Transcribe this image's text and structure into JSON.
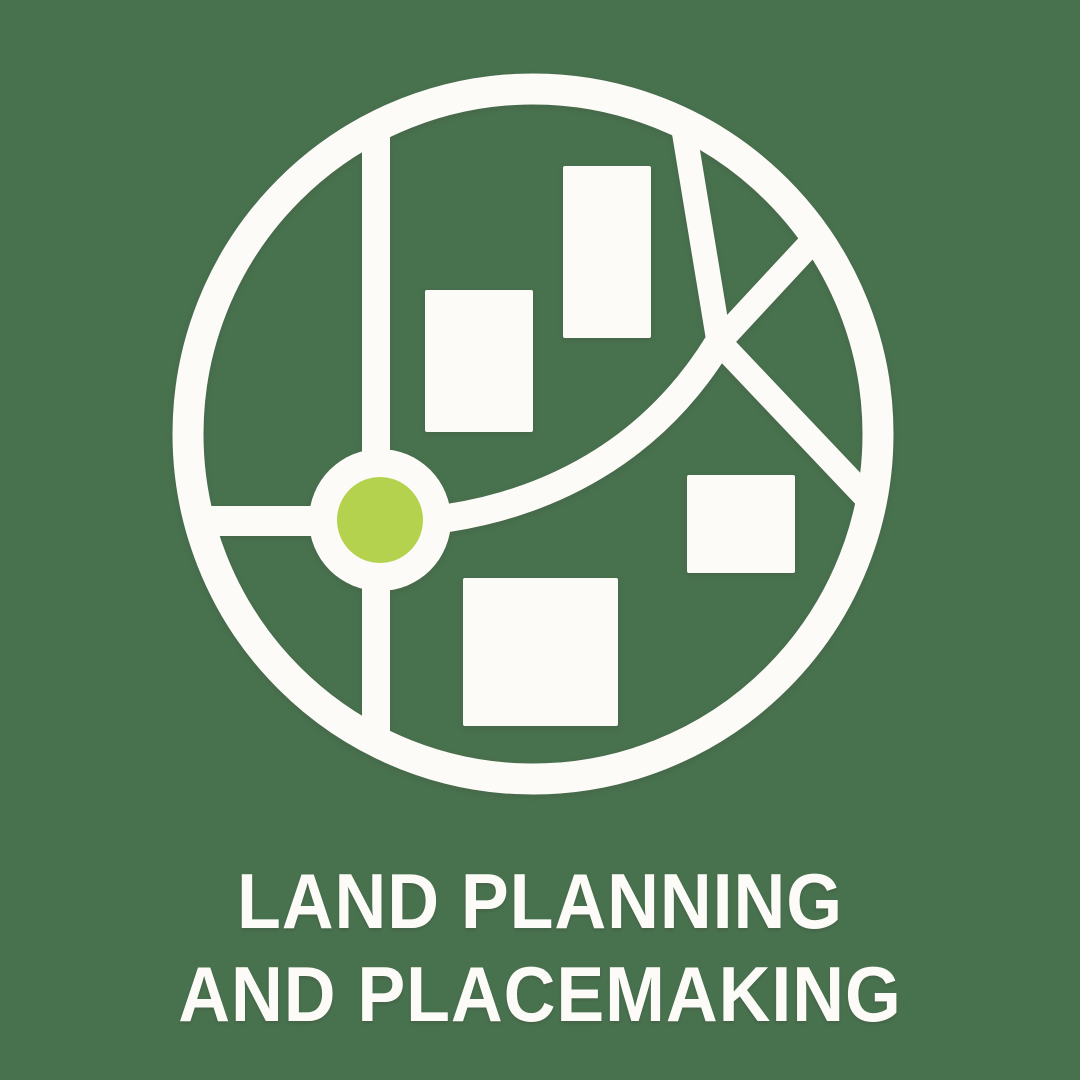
{
  "title": {
    "line1": "LAND PLANNING",
    "line2": "AND PLACEMAKING"
  },
  "icon": {
    "semantic": "land-plan-map-icon",
    "parts": [
      "map-boundary-circle",
      "road-vertical",
      "road-horizontal",
      "road-curve",
      "road-top-right",
      "road-branch-upper",
      "road-branch-lower",
      "building-block-1",
      "building-block-2",
      "building-block-3",
      "building-block-4",
      "roundabout-ring",
      "roundabout-center-dot"
    ]
  },
  "colors": {
    "background": "#48714E",
    "foreground": "#FCFBF8",
    "accent": "#B4D24D"
  }
}
